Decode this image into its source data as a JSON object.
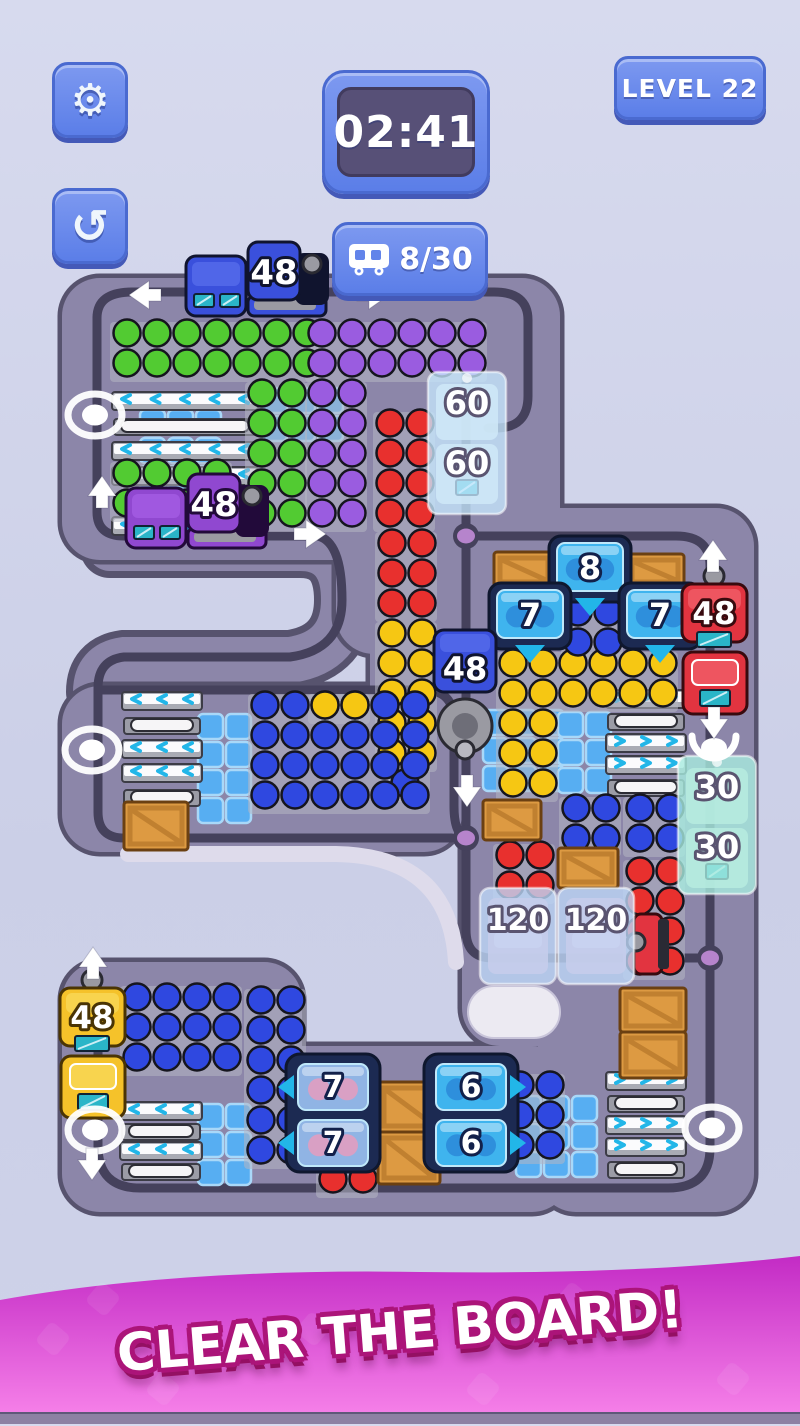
{
  "hud": {
    "timer": "02:41",
    "level_label": "LEVEL 22",
    "wagon_counter": "8/30",
    "settings_glyph": "⚙",
    "undo_glyph": "↺",
    "accent_blue": "#5b7ee8",
    "timer_bg": "#575077"
  },
  "banner": {
    "text": "CLEAR THE BOARD!",
    "bg_top": "#c32bc5",
    "bg_bottom": "#f884ea",
    "outline": "#ab1479"
  },
  "board": {
    "colors": {
      "board": "#8c86a9",
      "edge": "#57536e",
      "track": "#45415c",
      "seat": "#57aef2",
      "seatLine": "#a9d8f8",
      "conveyor": "#a9abb4",
      "conveyorDark": "#3c3c46",
      "chevron": "#22b6e8",
      "rack": "#b4b6c2",
      "crate": "#dd9a42",
      "crateDark": "#6b4012",
      "crateMid": "#c08030",
      "housing": "#1c2a52",
      "housingDark": "#0f172e",
      "cube": "#3fb4ee",
      "cubeBall": "#2e8fdc",
      "pinkBase": "#90b4e4",
      "pinkBall": "#d9a0c4",
      "ballStroke": "#15151e",
      "balls": {
        "green": "#52cb32",
        "purple": "#9a5ce0",
        "red": "#e8302e",
        "yellow": "#f6c713",
        "blue": "#2f48e0",
        "pink": "#e39cc2"
      },
      "trainBlue": "#3a50dc",
      "trainBlueLight": "#5066e8",
      "trainBlueDark": "#10142e",
      "trainPurple": "#9048d0",
      "trainPurpleLight": "#a058e0",
      "trainPurpleDark": "#220a3a",
      "trainRed": "#e23440",
      "trainRedLight": "#ee5560",
      "trainRedDark": "#380a0e",
      "trainYellow": "#f5c22a",
      "trainYellowLight": "#f8d44e",
      "trainYellowDark": "#4a3404",
      "teal": "#2ab5c8",
      "gray": "#9a9aa2",
      "grayDark": "#2a2a32",
      "ice60": "rgba(197,231,252,0.78)",
      "ice30": "rgba(168,235,222,0.8)",
      "ice120": "rgba(189,214,246,0.8)",
      "lightEdge": "#dedbeb",
      "capsule": "#eceaf2",
      "dot": "#b684cc",
      "arrow": "#ffffff"
    },
    "blocks": [
      [
        62,
        278,
        452,
        282
      ],
      [
        336,
        278,
        224,
        376
      ],
      [
        370,
        596,
        92,
        182
      ],
      [
        62,
        686,
        400,
        166
      ],
      [
        462,
        508,
        292,
        538
      ],
      [
        62,
        962,
        240,
        250
      ],
      [
        200,
        1046,
        370,
        166
      ],
      [
        538,
        962,
        216,
        250
      ]
    ],
    "bands": [
      "M110,548 H300 Q344,548 344,600 Q344,652 290,660 H124 Q96,664 96,692"
    ],
    "tracks": [
      "M97,318 Q97,292 132,292 H494 Q528,292 528,320 V396 Q528,428 496,428 H488",
      "M97,318 V512 Q97,536 124,536 H318",
      "M318,536 Q342,542 342,600 Q342,650 290,657 H124 Q98,660 98,688 V812 Q98,838 124,838 H452",
      "M98,690 H424 Q454,690 454,722 V806 Q454,834 466,838",
      "M466,368 V930 Q466,958 492,958 H710",
      "M466,536 H676 Q710,536 710,566 V1148 Q710,1188 668,1188 H140 Q98,1188 98,1146 V1010"
    ],
    "light_edges": [
      "M128,854 H336 Q450,856 456,962"
    ],
    "capsule": [
      468,
      986,
      92,
      52
    ],
    "junction_dots": [
      [
        466,
        536
      ],
      [
        466,
        838
      ],
      [
        710,
        958
      ]
    ],
    "track_ovals": [
      [
        95,
        415
      ],
      [
        92,
        750
      ],
      [
        95,
        1130
      ],
      [
        712,
        1128
      ]
    ],
    "arrows": [
      {
        "d": "left",
        "x": 146,
        "y": 295
      },
      {
        "d": "right",
        "x": 372,
        "y": 295
      },
      {
        "d": "up",
        "x": 102,
        "y": 493
      },
      {
        "d": "right",
        "x": 309,
        "y": 534
      },
      {
        "d": "up",
        "x": 713,
        "y": 557
      },
      {
        "d": "down",
        "x": 467,
        "y": 790
      },
      {
        "d": "down",
        "x": 714,
        "y": 722
      },
      {
        "d": "up",
        "x": 93,
        "y": 964
      },
      {
        "d": "down",
        "x": 92,
        "y": 1163
      }
    ],
    "claw": [
      714,
      748
    ],
    "seats": [
      [
        140,
        410,
        3,
        4
      ],
      [
        262,
        388,
        3,
        2
      ],
      [
        198,
        714,
        2,
        4
      ],
      [
        483,
        710,
        3,
        3
      ],
      [
        558,
        712,
        2,
        3
      ],
      [
        198,
        1104,
        2,
        3
      ],
      [
        516,
        1096,
        3,
        3
      ]
    ],
    "conveyors": [
      {
        "x": 112,
        "y": 392,
        "w": 146,
        "dir": "left",
        "rows": [
          "bar",
          "tray",
          "bar",
          "bar",
          "tray",
          "bar"
        ],
        "gap": 25
      },
      {
        "x": 122,
        "y": 692,
        "w": 80,
        "dir": "left",
        "rows": [
          "bar",
          "tray",
          "bar",
          "bar",
          "tray"
        ],
        "gap": 24
      },
      {
        "x": 606,
        "y": 690,
        "w": 80,
        "dir": "right",
        "rows": [
          "bar",
          "tray",
          "bar",
          "bar",
          "tray"
        ],
        "gap": 22
      },
      {
        "x": 606,
        "y": 1072,
        "w": 80,
        "dir": "right",
        "rows": [
          "bar",
          "tray",
          "bar",
          "bar",
          "tray"
        ],
        "gap": 22
      },
      {
        "x": 120,
        "y": 1102,
        "w": 82,
        "dir": "left",
        "rows": [
          "bar",
          "tray",
          "bar",
          "tray"
        ],
        "gap": 20
      }
    ],
    "ball_groups": [
      {
        "c": "green",
        "x": 112,
        "y": 318,
        "cols": 7,
        "rows": 2
      },
      {
        "c": "green",
        "x": 247,
        "y": 378,
        "cols": 2,
        "rows": 5
      },
      {
        "c": "green",
        "x": 112,
        "y": 458,
        "cols": 4,
        "rows": 2
      },
      {
        "c": "purple",
        "x": 307,
        "y": 318,
        "cols": 6,
        "rows": 2
      },
      {
        "c": "purple",
        "x": 307,
        "y": 378,
        "cols": 2,
        "rows": 5
      },
      {
        "c": "red",
        "x": 375,
        "y": 408,
        "cols": 2,
        "rows": 4
      },
      {
        "c": "red",
        "x": 377,
        "y": 528,
        "cols": 2,
        "rows": 3
      },
      {
        "c": "yellow",
        "x": 377,
        "y": 618,
        "cols": 2,
        "rows": 5
      },
      {
        "c": "blue",
        "x": 390,
        "y": 768,
        "cols": 1,
        "rows": 1
      },
      {
        "c": "blue",
        "x": 250,
        "y": 690,
        "cols": 6,
        "rows": 4
      },
      {
        "c": "yellow",
        "x": 310,
        "y": 690,
        "cols": 2,
        "rows": 1
      },
      {
        "c": "yellow",
        "x": 498,
        "y": 648,
        "cols": 6,
        "rows": 2
      },
      {
        "c": "yellow",
        "x": 498,
        "y": 708,
        "cols": 2,
        "rows": 3
      },
      {
        "c": "blue",
        "x": 561,
        "y": 793,
        "cols": 2,
        "rows": 2
      },
      {
        "c": "blue",
        "x": 625,
        "y": 793,
        "cols": 2,
        "rows": 2
      },
      {
        "c": "red",
        "x": 625,
        "y": 856,
        "cols": 2,
        "rows": 4
      },
      {
        "c": "red",
        "x": 495,
        "y": 840,
        "cols": 2,
        "rows": 2
      },
      {
        "c": "blue",
        "x": 563,
        "y": 597,
        "cols": 2,
        "rows": 2
      },
      {
        "c": "blue",
        "x": 122,
        "y": 982,
        "cols": 4,
        "rows": 3
      },
      {
        "c": "blue",
        "x": 246,
        "y": 985,
        "cols": 2,
        "rows": 6
      },
      {
        "c": "blue",
        "x": 505,
        "y": 1070,
        "cols": 2,
        "rows": 3
      },
      {
        "c": "red",
        "x": 318,
        "y": 1164,
        "cols": 2,
        "rows": 1
      }
    ],
    "crates": [
      [
        494,
        552,
        60,
        36
      ],
      [
        626,
        554,
        58,
        34
      ],
      [
        124,
        802,
        64,
        48
      ],
      [
        483,
        800,
        58,
        40
      ],
      [
        558,
        848,
        60,
        40
      ],
      [
        378,
        1082,
        62,
        50
      ],
      [
        378,
        1132,
        62,
        52
      ],
      [
        620,
        988,
        66,
        44
      ],
      [
        620,
        1032,
        66,
        46
      ]
    ],
    "cube_gates": [
      {
        "x": 549,
        "y": 536,
        "w": 82,
        "h": 66,
        "label": "8",
        "arrow": "down",
        "content": "blue"
      },
      {
        "x": 489,
        "y": 583,
        "w": 82,
        "h": 66,
        "label": "7",
        "arrow": "down",
        "content": "blue"
      },
      {
        "x": 619,
        "y": 583,
        "w": 82,
        "h": 66,
        "label": "7",
        "arrow": "down",
        "content": "blue"
      }
    ],
    "double_gates": [
      {
        "x": 286,
        "y": 1054,
        "w": 94,
        "h": 118,
        "labels": [
          "7",
          "7"
        ],
        "arrow": "left",
        "content": "pink"
      },
      {
        "x": 424,
        "y": 1054,
        "w": 94,
        "h": 118,
        "labels": [
          "6",
          "6"
        ],
        "arrow": "right",
        "content": "blue"
      }
    ],
    "ice_gates": [
      {
        "x": 428,
        "y": 372,
        "w": 78,
        "h": 142,
        "labels": [
          "60",
          "60"
        ],
        "tint": "ice60"
      },
      {
        "x": 678,
        "y": 756,
        "w": 78,
        "h": 138,
        "labels": [
          "30",
          "30"
        ],
        "tint": "ice30"
      }
    ],
    "frozen_wagons": [
      {
        "x": 480,
        "y": 888,
        "w": 76,
        "h": 96,
        "label": "120"
      },
      {
        "x": 558,
        "y": 888,
        "w": 76,
        "h": 96,
        "label": "120"
      }
    ],
    "frozen_engine_nose": [
      634,
      914
    ],
    "trains": [
      {
        "kind": "h",
        "color": "blue",
        "label": "48",
        "x": 186,
        "y": 242
      },
      {
        "kind": "h",
        "color": "purple",
        "label": "48",
        "x": 126,
        "y": 474
      },
      {
        "kind": "vdown",
        "color": "blue",
        "label": "48",
        "x": 434,
        "y": 630
      },
      {
        "kind": "vup",
        "color": "red",
        "label": "48",
        "x": 682,
        "y": 576
      },
      {
        "kind": "vup",
        "color": "yellow",
        "label": "48",
        "x": 60,
        "y": 980
      }
    ]
  }
}
